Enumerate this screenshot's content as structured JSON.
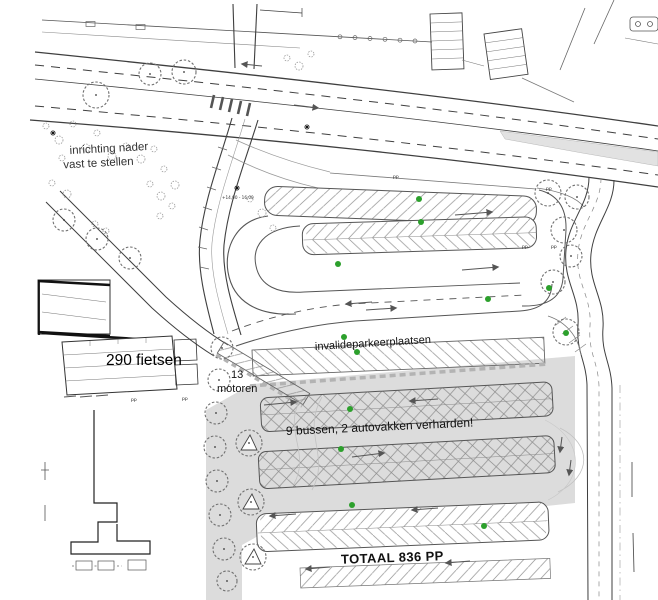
{
  "plan": {
    "labels": {
      "inrichting_line1": "inrichting nader",
      "inrichting_line2": "vast te stellen",
      "fietsen": "290 fietsen",
      "motoren_line1": "13",
      "motoren_line2": "motoren",
      "invalide": "invalideparkeerplaatsen",
      "bussen": "9 bussen, 2 autovakken verharden!",
      "totaal": "TOTAAL 836 PP",
      "pp_marker": "pp",
      "elevation_note": "+14,00 - 16,00"
    },
    "counts": {
      "fietsen": 290,
      "motoren": 13,
      "bussen": 9,
      "autovakken": 2,
      "totaal_pp": 836
    },
    "colors": {
      "paved_gray": "#dcdcdc",
      "line_dark": "#3f3f3f",
      "hatch_gray": "#909090",
      "green_dot": "#2ca02c"
    }
  }
}
